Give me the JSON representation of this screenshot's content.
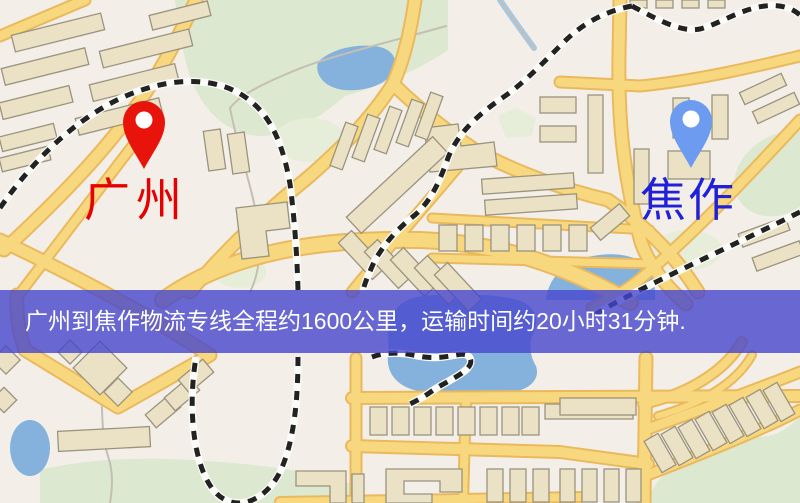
{
  "map": {
    "origin_marker": {
      "label": "广州"
    },
    "destination_marker": {
      "label": "焦作"
    },
    "banner": {
      "text": "广州到焦作物流专线全程约1600公里，运输时间约20小时31分钟."
    }
  },
  "icons": {
    "origin_pin": "red-map-pin-icon",
    "destination_pin": "blue-map-pin-icon"
  },
  "colors": {
    "map_bg": "#f3efe8",
    "road": "#f8d87e",
    "road_border": "#eab95e",
    "building": "#ebe2c6",
    "building_border": "#9a937e",
    "park": "#dce8cf",
    "park_light": "#e6eeda",
    "water": "#85b2dc",
    "railway": "#222222",
    "railway_base": "#fbfbf8",
    "stream": "#c4bfb2",
    "origin_pin": "#e8140c",
    "origin_pin_center": "#ffffff",
    "origin_label": "#e60000",
    "destination_pin": "#6d9bf0",
    "destination_pin_center": "#ffffff",
    "destination_label": "#2020d8",
    "banner_bg": "rgba(70,70,205,0.8)",
    "banner_text": "#ffffff"
  }
}
